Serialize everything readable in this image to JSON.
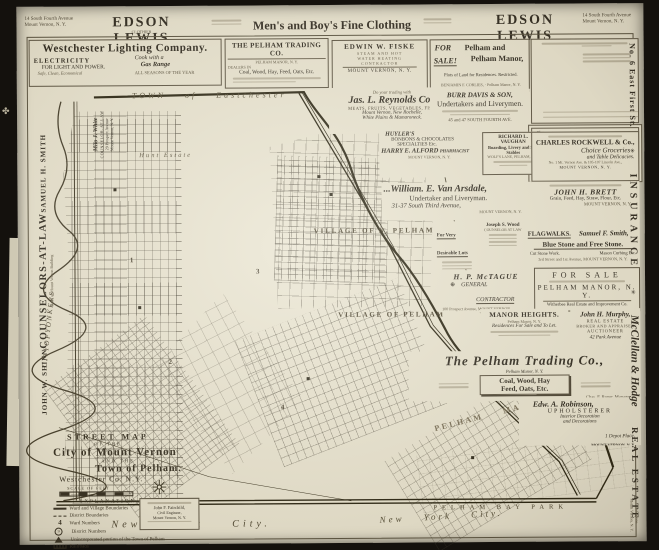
{
  "header": {
    "left_address": [
      "14 South Fourth Avenue",
      "Mount Vernon, N. Y."
    ],
    "left_brand": "EDSON LEWIS",
    "brand_sub": "CLOTHIER",
    "center": "Men's and Boy's Fine Clothing",
    "right_brand": "EDSON LEWIS",
    "right_address": [
      "14 South Fourth Avenue",
      "Mount Vernon, N. Y."
    ]
  },
  "left_margin": {
    "name_bottom": "JOHN W. SHINN",
    "firm_title": "COUNSELORS-AT-LAW",
    "firm_sub": "Bank of Mount Vernon Building",
    "name_top": "SAMUEL H. SMITH",
    "ornament": "✤",
    "white": [
      "Milo J. White",
      "COUNSELOR-AT-LAW",
      "29 Prospect Avenue",
      "Mount Vernon, N. Y."
    ]
  },
  "right_margin": {
    "address": "No. 6 East First St.",
    "ornament": "✳",
    "insurance": "INSURANCE",
    "firm": "McClellan & Hodge",
    "estate": "REAL ESTATE",
    "phone1": "Telephone",
    "phone2": "Mount Vernon, N. Y."
  },
  "ads": {
    "westchester": {
      "title": "Westchester Lighting Company.",
      "electricity": "ELECTRICITY",
      "light_power": "FOR LIGHT AND POWER.",
      "safe": "Safe, Clean, Economical",
      "cook1": "Cook with a",
      "cook2": "Gas Range",
      "seasons": "ALL SEASONS OF THE YEAR"
    },
    "pelham_trading_top": {
      "title": "THE PELHAM TRADING CO.",
      "sub": "PELHAM MANOR, N. Y.",
      "dealers": "DEALERS IN",
      "goods": "Coal, Wood, Hay, Feed, Oats, Etc."
    },
    "fiske": {
      "name": "EDWIN W. FISKE",
      "l1": "STEAM AND HOT",
      "l2": "WATER HEATING",
      "l3": "CONTRACTOR",
      "city": "MOUNT VERNON, N. Y."
    },
    "corlies": {
      "fs1": "FOR",
      "fs2": "SALE!",
      "t1": "Pelham and",
      "t2": "Pelham Manor,",
      "plots": "Plots of Land for Residences.  Restricted.",
      "agent": "BENJAMIN F. CORLIES,  ·  Pelham Manor, N. Y."
    },
    "reynolds": {
      "lead": "Do your trading with",
      "name": "Jas. L. Reynolds Co.,",
      "goods": "MEATS, FRUITS, VEGETABLES, FISH",
      "c1": "Mount Vernon, New Rochelle,",
      "c2": "White Plains & Mamaroneck."
    },
    "burr": {
      "name": "BURR DAVIS & SON,",
      "trade": "Undertakers and Liverymen.",
      "addr": "45 and 47 SOUTH FOURTH AVE."
    },
    "vannamee": {
      "shop": "Shop at...",
      "addr": "45 SOUTH 4th AVENUE",
      "name": "Van Namee's!",
      "line1": "“Onyx Hosiery,”",
      "line2": "“R. & G. Corsets.”"
    },
    "alford": {
      "h1": "HUYLER'S",
      "h2": "BONBONS & CHOCOLATES",
      "h3": "SPECIALTIES Etc.",
      "name": "HARRY E. ALFORD",
      "trade": "PHARMACIST",
      "city": "MOUNT VERNON, N. Y."
    },
    "vaughan": {
      "name": "RICHARD L. VAUGHAN",
      "trade": "Boarding, Livery and Sale Stables",
      "addr": "WOLF'S LANE, PELHAM, N. Y."
    },
    "rockwell": {
      "name": "CHARLES ROCKWELL & Co.,",
      "g1": "Choice Groceries",
      "g2": "and Table Delicacies.",
      "addr": "No. 1 Mt. Vernon Ave. & 105-107 Lincoln Ave.,",
      "city": "MOUNT VERNON, N. Y."
    },
    "arsdale": {
      "name": "...William. E. Van Arsdale,",
      "trade": "Undertaker and Liveryman.",
      "addr": "31-37 South Third Avenue,",
      "city": "MOUNT VERNON, N. Y."
    },
    "brett": {
      "name": "JOHN H. BRETT",
      "goods": "Grain, Feed, Hay, Straw, Flour, Etc.",
      "city": "MOUNT VERNON, N. Y."
    },
    "woodlots": {
      "l1": "For Very",
      "l2": "Desirable Lots",
      "name": "JOSEPH S. WOOD"
    },
    "woodlaw": {
      "name": "Joseph S. Wood",
      "title": "COUNSELOR AT LAW"
    },
    "smith": {
      "flag": "FLAGWALKS.",
      "name": "Samuel F. Smith,",
      "stone": "Blue Stone and Free Stone.",
      "w1": "Cut Stone Work.",
      "w2": "Mason Curbing Etc.",
      "addr": "3rd Street and 1st Avenue,  MOUNT VERNON, N. Y."
    },
    "mctague": {
      "name": "H. P. McTAGUE",
      "g": "GENERAL",
      "c": "CONTRACTOR",
      "mark": "⊕",
      "addr": "100 Prospect Avenue,",
      "city": "MOUNT VERNON"
    },
    "witherbee": {
      "h": "FOR SALE",
      "place": "PELHAM MANOR, N. Y.",
      "co": "Witherbee Real Estate and Improvement Co."
    },
    "manor_heights": {
      "name": "MANOR HEIGHTS.",
      "place": "Pelham Manor, N. Y.",
      "line": "Residences For Sale and To Let."
    },
    "murphy": {
      "name": "John H. Murphy,",
      "l1": "REAL ESTATE",
      "l2": "BROKER AND APPRAISER",
      "l3": "AUCTIONEER",
      "addr": "42 Park Avenue"
    },
    "trading": {
      "title": "The Pelham Trading Co.,",
      "sub": "Pelham Manor, N. Y.",
      "g1": "Coal, Wood, Hay",
      "g2": "Feed, Oats, Etc.",
      "mgr": "Chas. F. Roper, Manager"
    },
    "robinson": {
      "name": "Edw. A. Robinson,",
      "trade": "UPHOLSTERER",
      "l1": "Interior Decoration",
      "l2": "and Decorations",
      "addr": "1 Depot Place,",
      "city": "MOUNT VERNON, N. Y."
    }
  },
  "map": {
    "eastchester": {
      "t1": "TOWN",
      "t2": "of",
      "t3": "Eastchester"
    },
    "yonkers": "C I T Y   O F   Y O N K E R S",
    "hunt": "Hunt Estate",
    "n_pelham": "VILLAGE OF N. PELHAM",
    "pelham_village": "VILLAGE OF PELHAM",
    "manor": {
      "a": "PELHAM",
      "b": "MANOR"
    },
    "bay_park": "PELHAM  BAY  PARK",
    "nyc": "New   York   City.",
    "ward_numbers": [
      "1",
      "2",
      "3",
      "4"
    ],
    "title_block": {
      "l1": "STREET MAP",
      "l2": "OF THE",
      "l3": "City of Mount Vernon",
      "l4": "AND THE",
      "l5": "Town of Pelham.",
      "l6": "Westchester Co. N.Y.",
      "scale": "SCALE OF FEET",
      "explanation": "EXPLANATION",
      "legend": [
        {
          "label": "Ward and Village Boundaries"
        },
        {
          "label": "District Boundaries"
        },
        {
          "label": "Ward Numbers"
        },
        {
          "label": "District Numbers"
        },
        {
          "label": "Unincorporated portion of the Town of Pelham"
        },
        {
          "label": "Railroads"
        },
        {
          "label": "Proposed Electric R.R. Extensions"
        },
        {
          "label": "Important Buildings"
        },
        {
          "label": "Parks"
        }
      ]
    },
    "surveyor": {
      "l1": "John F. Fairchild,",
      "l2": "Civil Engineer,",
      "l3": "Mount Vernon, N. Y."
    }
  }
}
